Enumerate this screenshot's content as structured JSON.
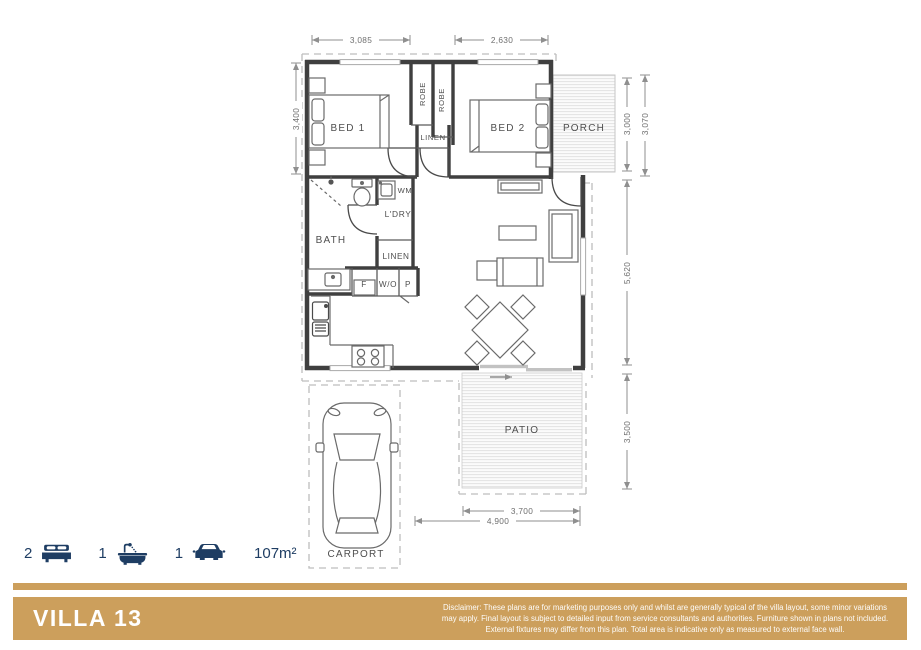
{
  "plan": {
    "room_labels": {
      "bed1": "BED 1",
      "bed2": "BED 2",
      "bath": "BATH",
      "laundry": "L'DRY",
      "porch": "PORCH",
      "patio": "PATIO",
      "carport": "CARPORT"
    },
    "storage_labels": {
      "robe1": "ROBE",
      "robe2": "ROBE",
      "linen1": "LINEN",
      "linen2": "LINEN"
    },
    "fixture_labels": {
      "washing_machine": "WM",
      "fridge": "F",
      "wall_oven": "W/O",
      "pantry": "P"
    },
    "dimensions": {
      "bed1_width": "3,085",
      "bed2_width": "2,630",
      "bed1_depth": "3,400",
      "porch_depth": "3,000",
      "porch_depth_overall": "3,070",
      "living_depth": "5,620",
      "patio_depth": "3,500",
      "patio_width": "3,700",
      "patio_width_overall": "4,900"
    }
  },
  "summary": {
    "bedrooms": "2",
    "bathrooms": "1",
    "carspaces": "1",
    "area": "107m²"
  },
  "footer": {
    "title": "VILLA 13",
    "disclaimer": "Disclaimer: These plans are for marketing purposes only and whilst are generally typical of the villa layout, some minor variations may apply. Final layout is subject to detailed input from service consultants and authorities. Furniture shown in plans not included. External fixtures may differ from this plan. Total area is indicative only as measured to external face wall."
  },
  "colors": {
    "accent_gold": "#cc9f5c",
    "icon_navy": "#1e3d63"
  }
}
